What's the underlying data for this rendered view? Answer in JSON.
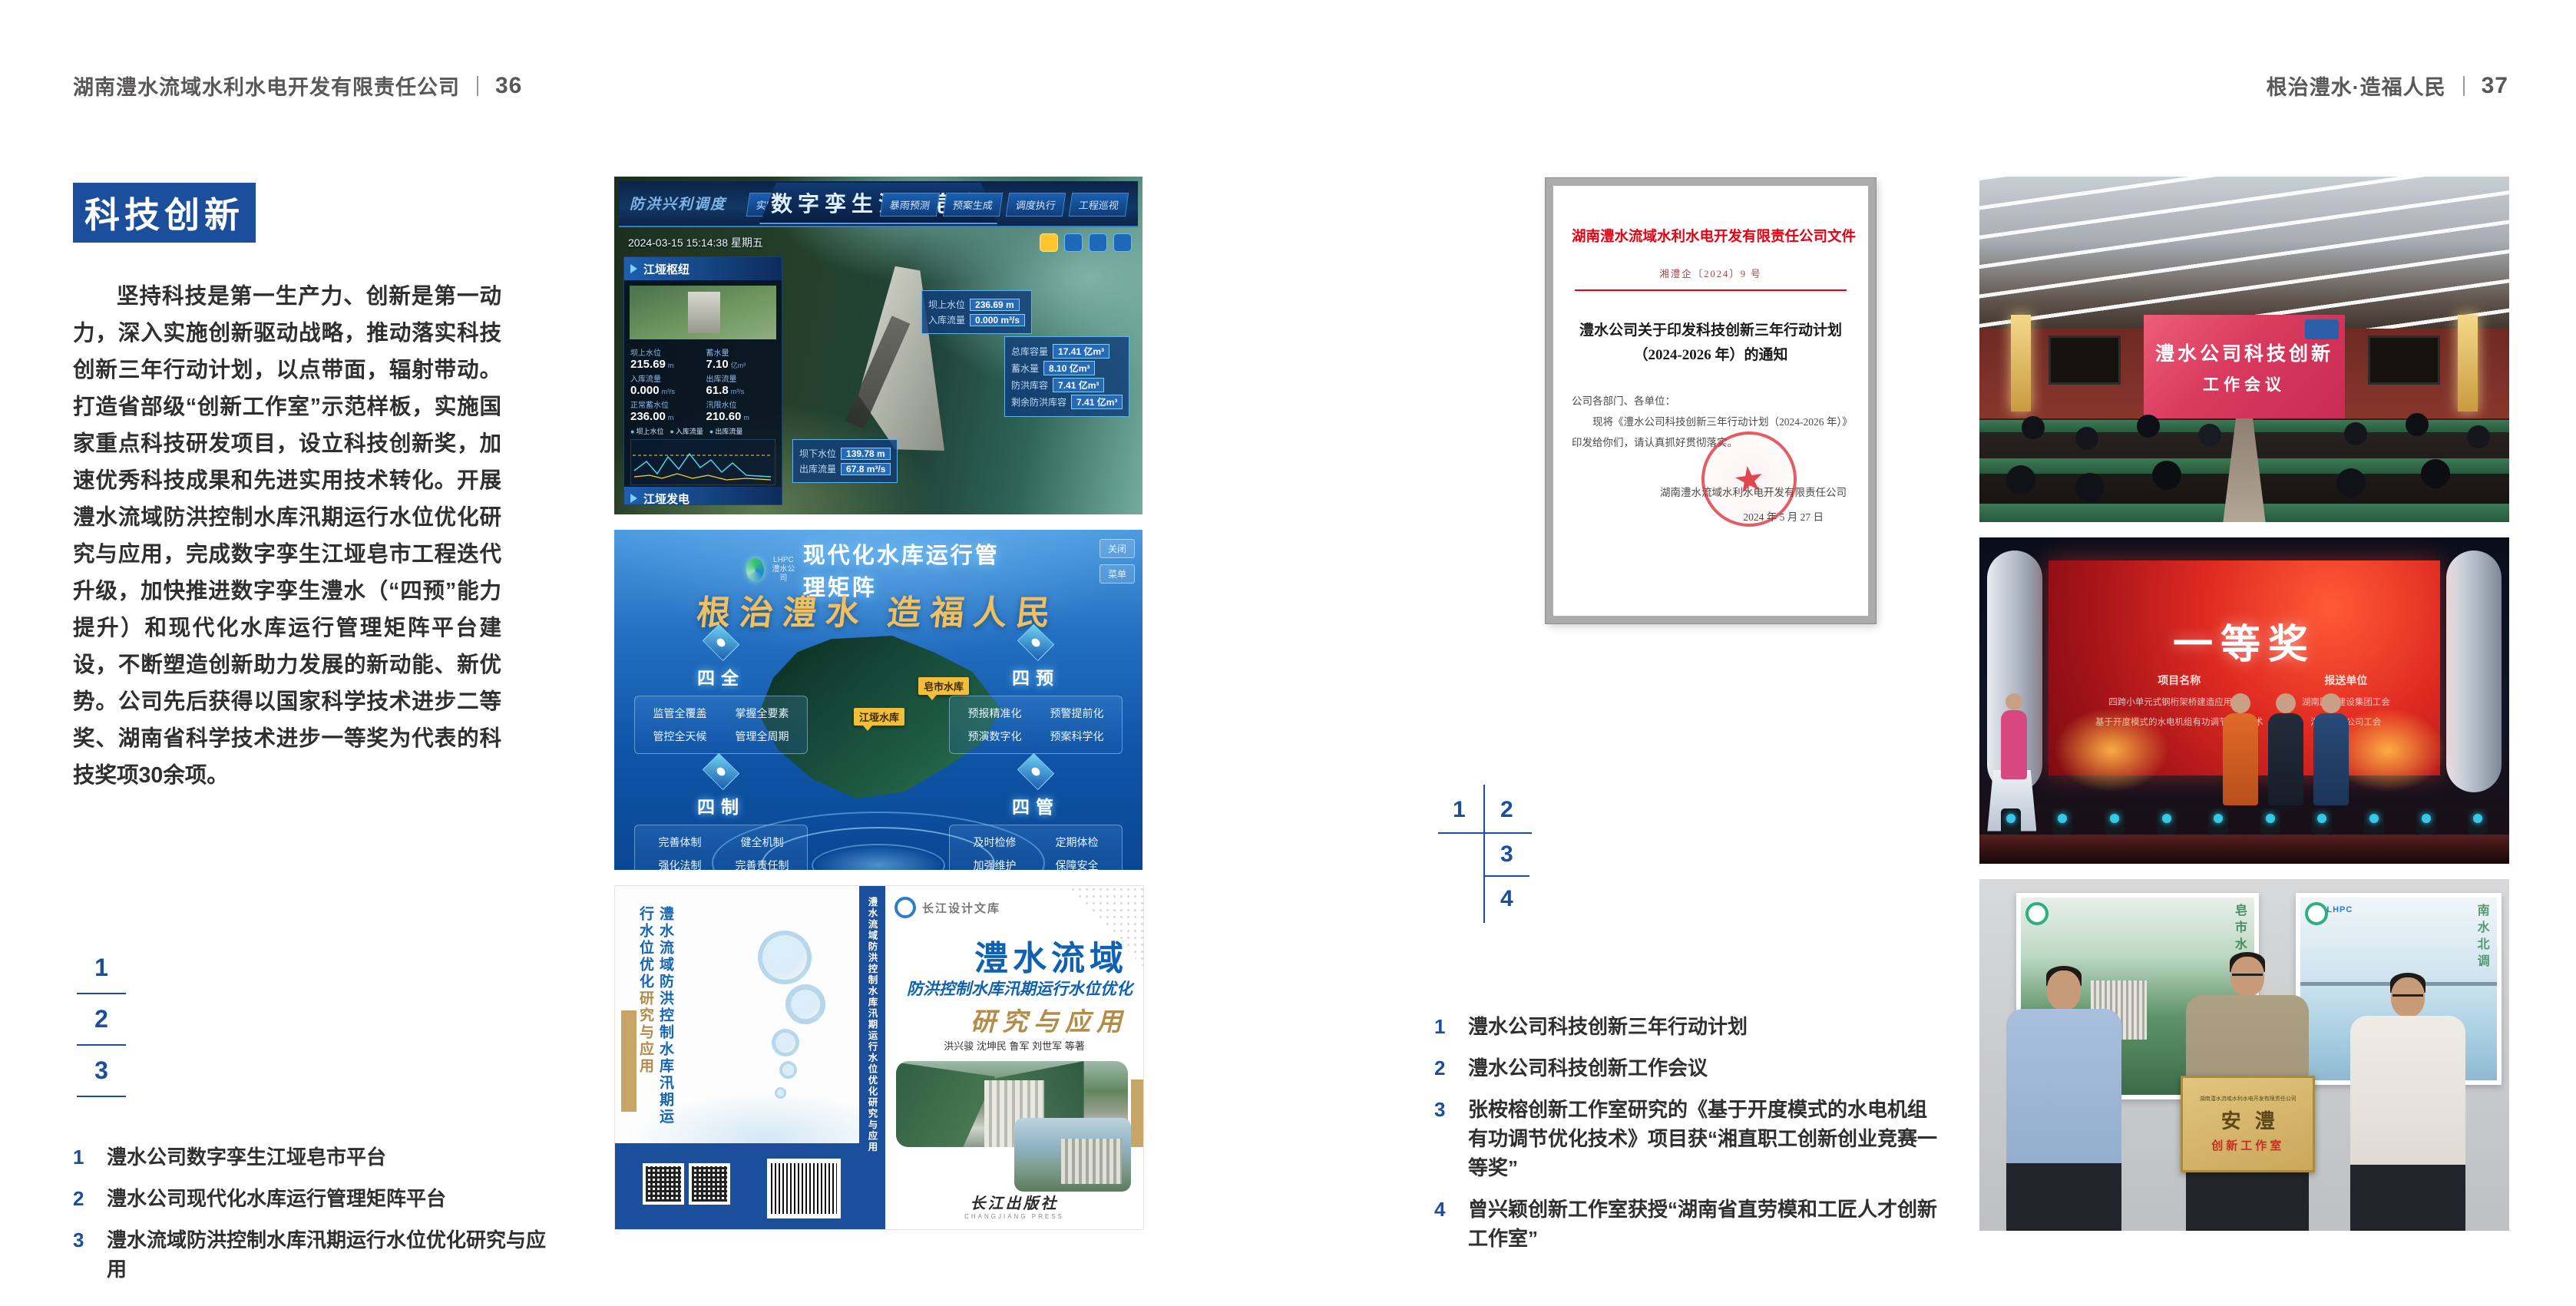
{
  "colors": {
    "accent_blue": "#1b4e9b",
    "doc_red": "#e60012",
    "gold": "#c6a566"
  },
  "left": {
    "header": {
      "company": "湖南澧水流域水利水电开发有限责任公司",
      "page": "36"
    },
    "badge": "科技创新",
    "paragraph": "坚持科技是第一生产力、创新是第一动力，深入实施创新驱动战略，推动落实科技创新三年行动计划，以点带面，辐射带动。打造省部级“创新工作室”示范样板，实施国家重点科技研发项目，设立科技创新奖，加速优秀科技成果和先进实用技术转化。开展澧水流域防洪控制水库汛期运行水位优化研究与应用，完成数字孪生江垭皂市工程迭代升级，加快推进数字孪生澧水（“四预”能力提升）和现代化水库运行管理矩阵平台建设，不断塑造创新助力发展的新动能、新优势。公司先后获得以国家科学技术进步二等奖、湖南省科学技术进步一等奖为代表的科技奖项30余项。",
    "index_nums": [
      "1",
      "2",
      "3"
    ],
    "captions": [
      {
        "num": "1",
        "text": "澧水公司数字孪生江垭皂市平台"
      },
      {
        "num": "2",
        "text": "澧水公司现代化水库运行管理矩阵平台"
      },
      {
        "num": "3",
        "text": "澧水流域防洪控制水库汛期运行水位优化研究与应用"
      }
    ],
    "digital_twin": {
      "corner": "防洪兴利调度",
      "title": "数字孪生江垭皂市",
      "tabs_left": [
        "实时监测",
        "洪水预报",
        "防洪预演"
      ],
      "tabs_right": [
        "暴雨预测",
        "预案生成",
        "调度执行",
        "工程巡视"
      ],
      "timestamp": "2024-03-15 15:14:38 星期五",
      "panel_hub": "江垭枢纽",
      "hub_stats": [
        {
          "label": "坝上水位",
          "value": "215.69",
          "unit": "m"
        },
        {
          "label": "蓄水量",
          "value": "7.10",
          "unit": "亿m³"
        },
        {
          "label": "入库流量",
          "value": "0.000",
          "unit": "m³/s"
        },
        {
          "label": "出库流量",
          "value": "61.8",
          "unit": "m³/s"
        },
        {
          "label": "正常蓄水位",
          "value": "236.00",
          "unit": "m"
        },
        {
          "label": "汛限水位",
          "value": "210.60",
          "unit": "m"
        }
      ],
      "legend": [
        "坝上水位",
        "入库流量",
        "出库流量"
      ],
      "panel_power": "江垭发电",
      "power_stats": [
        {
          "label": "年发电计划",
          "value": "63000",
          "unit": "万kW·h"
        },
        {
          "label": "年累计发电量",
          "value": "6.2907",
          "unit": "亿kW·h"
        },
        {
          "label": "月累计发电量",
          "value": "3259.21",
          "unit": "万kW·h"
        },
        {
          "label": "当前出力",
          "value": "0.00",
          "unit": "MW"
        }
      ],
      "callout_top": [
        {
          "label": "坝上水位",
          "value": "236.69 m"
        },
        {
          "label": "入库流量",
          "value": "0.000 m³/s"
        }
      ],
      "callout_right": [
        {
          "label": "总库容量",
          "value": "17.41 亿m³"
        },
        {
          "label": "蓄水量",
          "value": "8.10 亿m³"
        },
        {
          "label": "防洪库容",
          "value": "7.41 亿m³"
        },
        {
          "label": "剩余防洪库容",
          "value": "7.41 亿m³"
        }
      ],
      "callout_bottom": [
        {
          "label": "坝下水位",
          "value": "139.78 m"
        },
        {
          "label": "出库流量",
          "value": "67.8 m³/s"
        }
      ]
    },
    "matrix": {
      "logo": "LHPC",
      "logo_sub": "澧水公司",
      "title": "现代化水库运行管理矩阵",
      "slogan": "根治澧水 造福人民",
      "buttons": [
        "关闭",
        "菜单"
      ],
      "map_tags": [
        "皂市水库",
        "江垭水库"
      ],
      "groups": [
        {
          "name": "四全",
          "items": [
            "监管全覆盖",
            "掌握全要素",
            "管控全天候",
            "管理全周期"
          ]
        },
        {
          "name": "四预",
          "items": [
            "预报精准化",
            "预警提前化",
            "预演数字化",
            "预案科学化"
          ]
        },
        {
          "name": "四制",
          "items": [
            "完善体制",
            "健全机制",
            "强化法制",
            "完善责任制"
          ]
        },
        {
          "name": "四管",
          "items": [
            "及时检修",
            "定期体检",
            "加强维护",
            "保障安全"
          ]
        }
      ]
    },
    "book": {
      "series": "长江设计文库",
      "title_main": "澧水流域",
      "title_sub": "防洪控制水库汛期运行水位优化",
      "title_tail": "研究与应用",
      "authors": "洪兴骏  沈坤民  鲁军  刘世军  等著",
      "publisher": "长江出版社",
      "publisher_en": "CHANGJIANG PRESS",
      "spine": "澧水流域防洪控制水库汛期运行水位优化研究与应用"
    }
  },
  "right": {
    "header": {
      "slogan": "根治澧水·造福人民",
      "page": "37"
    },
    "document": {
      "header": "湖南澧水流域水利水电开发有限责任公司文件",
      "doc_no": "湘澧企〔2024〕9 号",
      "title_line1": "澧水公司关于印发科技创新三年行动计划",
      "title_line2": "（2024-2026 年）的通知",
      "salutation": "公司各部门、各单位：",
      "body": "现将《澧水公司科技创新三年行动计划（2024-2026 年）》印发给你们，请认真抓好贯彻落实。",
      "signature": "湖南澧水流域水利水电开发有限责任公司",
      "date": "2024 年 5 月 27 日",
      "seal_star": "★"
    },
    "index_nums": [
      "1",
      "2",
      "3",
      "4"
    ],
    "captions": [
      {
        "num": "1",
        "text": "澧水公司科技创新三年行动计划"
      },
      {
        "num": "2",
        "text": "澧水公司科技创新工作会议"
      },
      {
        "num": "3",
        "text": "张桉榕创新工作室研究的《基于开度模式的水电机组有功调节优化技术》项目获“湘直职工创新创业竞赛一等奖”"
      },
      {
        "num": "4",
        "text": "曾兴颖创新工作室获授“湖南省直劳模和工匠人才创新工作室”"
      }
    ],
    "meeting": {
      "line1": "澧水公司科技创新",
      "line2": "工作会议"
    },
    "award": {
      "title": "一等奖",
      "col1": "项目名称",
      "col2": "报送单位",
      "rows": [
        {
          "project": "四跨小单元式钢桁架桥建造应用技术",
          "org": "湖南路桥建设集团工会"
        },
        {
          "project": "基于开度模式的水电机组有功调节优化技术",
          "org": "湖南澧水公司工会"
        }
      ]
    },
    "plaque": {
      "poster_left_text": "皂市水库",
      "poster_right_text": "南水北调",
      "poster_logo": "LHPC",
      "header": "湖南澧水流域水利水电开发有限责任公司",
      "big": "安澧",
      "sub": "创新工作室"
    }
  }
}
